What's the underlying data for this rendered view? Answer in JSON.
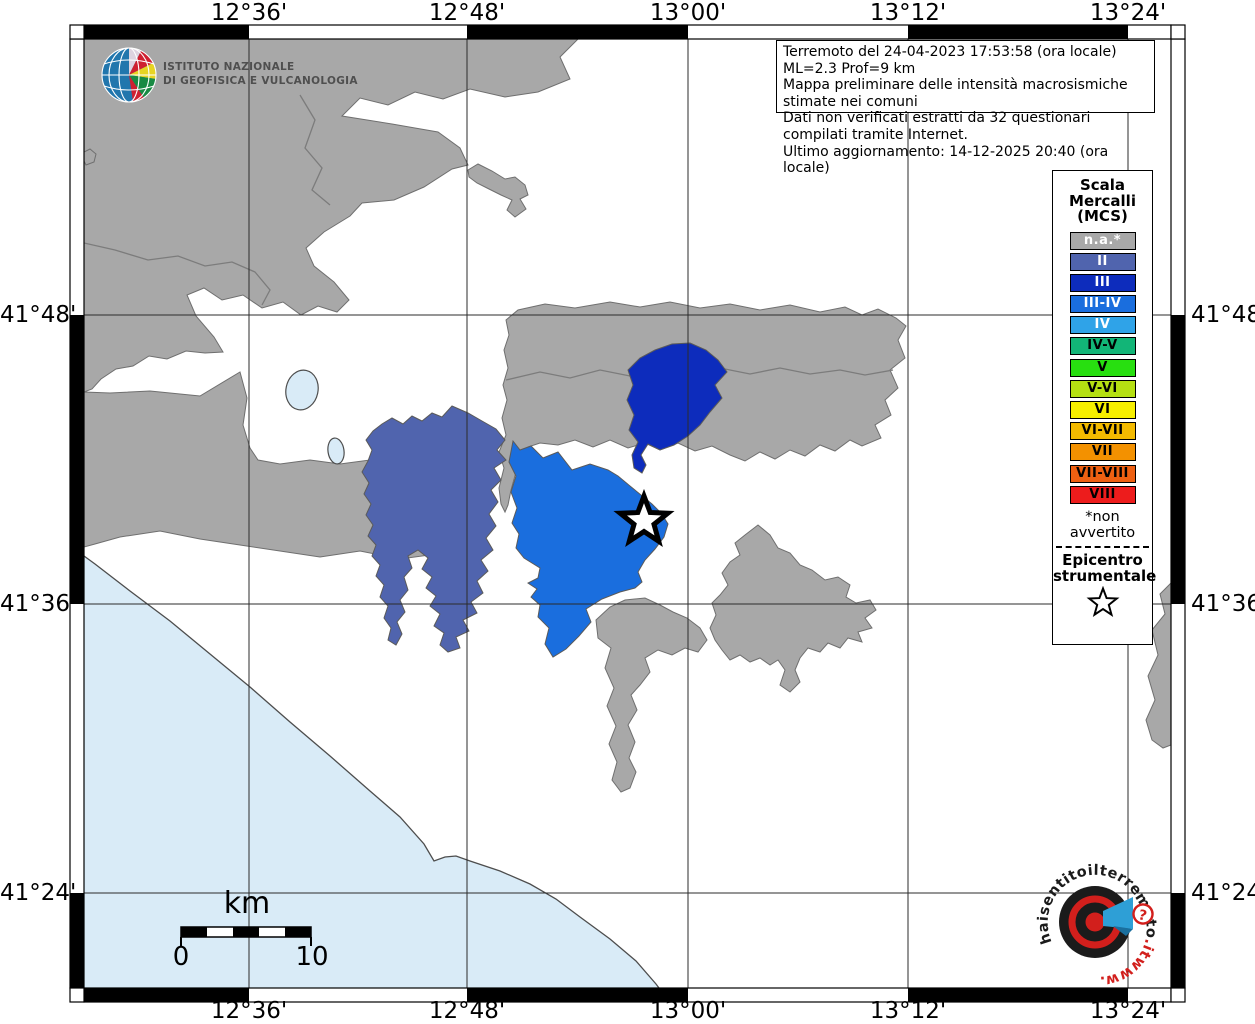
{
  "colors": {
    "na": "#a8a8a8",
    "II": "#5064ae",
    "III": "#0d2cbc",
    "III_IV": "#1a6ede",
    "IV": "#2fa3e8",
    "IV_V": "#12b577",
    "V": "#28df10",
    "V_VI": "#b5e012",
    "VI": "#f6ef00",
    "VI_VII": "#f3ba00",
    "VII": "#f39100",
    "VII_VIII": "#ee6012",
    "VIII": "#ed1c1c",
    "sea": "#d9ebf7",
    "region_border": "#6f6f6f"
  },
  "header": {
    "ingv_line1": "ISTITUTO NAZIONALE",
    "ingv_line2": "DI GEOFISICA E VULCANOLOGIA",
    "info_lines": [
      "Terremoto del 24-04-2023 17:53:58 (ora locale) ML=2.3 Prof=9 km",
      "Mappa preliminare delle intensità macrosismiche stimate nei comuni",
      "Dati non verificati estratti da 32 questionari compilati tramite Internet.",
      "Ultimo aggiornamento: 14-12-2025 20:40 (ora locale)"
    ]
  },
  "legend": {
    "title_lines": [
      "Scala",
      "Mercalli",
      "(MCS)"
    ],
    "items": [
      {
        "label": "n.a.*",
        "text_color": "#ffffff"
      },
      {
        "label": "II",
        "text_color": "#ffffff"
      },
      {
        "label": "III",
        "text_color": "#ffffff"
      },
      {
        "label": "III-IV",
        "text_color": "#ffffff"
      },
      {
        "label": "IV",
        "text_color": "#ffffff"
      },
      {
        "label": "IV-V",
        "text_color": "#000000"
      },
      {
        "label": "V",
        "text_color": "#000000"
      },
      {
        "label": "V-VI",
        "text_color": "#000000"
      },
      {
        "label": "VI",
        "text_color": "#000000"
      },
      {
        "label": "VI-VII",
        "text_color": "#000000"
      },
      {
        "label": "VII",
        "text_color": "#000000"
      },
      {
        "label": "VII-VIII",
        "text_color": "#000000"
      },
      {
        "label": "VIII",
        "text_color": "#000000"
      }
    ],
    "footnote": "*non avvertito",
    "epicenter_line1": "Epicentro",
    "epicenter_line2": "strumentale"
  },
  "axes": {
    "lon_labels": [
      "12°36'",
      "12°48'",
      "13°00'",
      "13°12'",
      "13°24'"
    ],
    "lat_labels": [
      "41°48'",
      "41°36'",
      "41°24'"
    ]
  },
  "scalebar": {
    "unit": "km",
    "start": "0",
    "end": "10"
  },
  "watermark": {
    "www": "www.",
    "main": "haisentitoilterremoto",
    "tld": ".it",
    "question": "?"
  }
}
